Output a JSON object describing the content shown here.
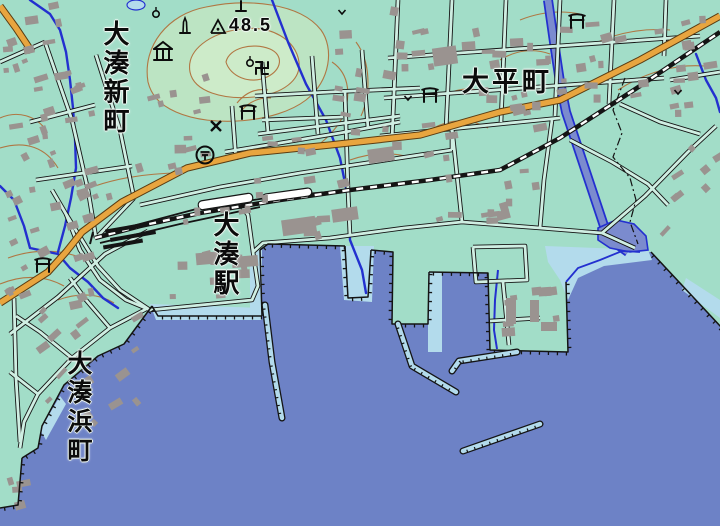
{
  "map": {
    "labels": {
      "shinmachi": "大湊新町",
      "taiheicho": "大平町",
      "station": "大湊駅",
      "hamamachi": "大湊浜町",
      "elevation": "48.5"
    },
    "symbols": [
      {
        "type": "triangulation-point",
        "x": 218,
        "y": 27
      },
      {
        "type": "monument",
        "x": 185,
        "y": 26
      },
      {
        "type": "cemetery",
        "x": 241,
        "y": 7
      },
      {
        "type": "museum",
        "x": 163,
        "y": 53
      },
      {
        "type": "temple",
        "x": 262,
        "y": 68
      },
      {
        "type": "shrine",
        "x": 248,
        "y": 112
      },
      {
        "type": "shrine",
        "x": 430,
        "y": 95
      },
      {
        "type": "shrine",
        "x": 43,
        "y": 265
      },
      {
        "type": "shrine",
        "x": 577,
        "y": 21
      },
      {
        "type": "police-box",
        "x": 216,
        "y": 126
      },
      {
        "type": "post-office",
        "x": 205,
        "y": 155
      },
      {
        "type": "landmark-circle",
        "x": 156,
        "y": 14
      },
      {
        "type": "landmark-circle",
        "x": 250,
        "y": 63
      },
      {
        "type": "field",
        "x": 342,
        "y": 12
      },
      {
        "type": "field",
        "x": 408,
        "y": 98
      },
      {
        "type": "field",
        "x": 678,
        "y": 92
      }
    ],
    "colors": {
      "land": "#a2ddc8",
      "water": "#6d82c6",
      "shallow_water": "#b3dbec",
      "hill": "#bce4c3",
      "road_major": "#e8a53f",
      "road_minor_fill": "#cfeee2",
      "river": "#2330cf",
      "building": "#9a9390",
      "contour": "#b0713c",
      "rail": "#141414",
      "label_text": "#0b0b0b"
    }
  }
}
